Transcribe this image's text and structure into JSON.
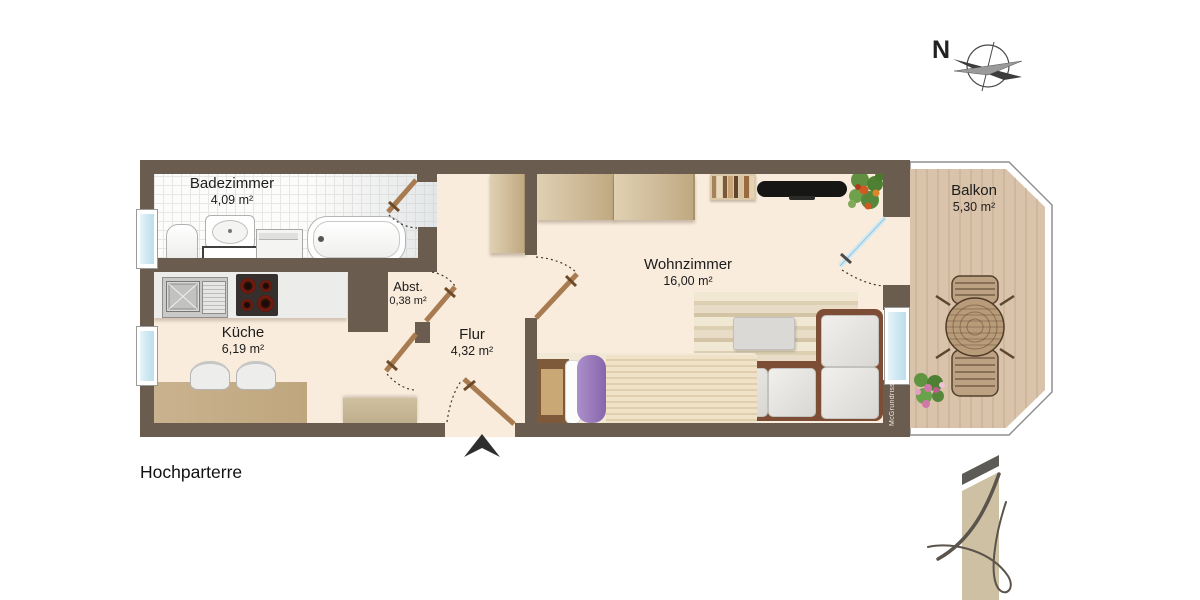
{
  "plan": {
    "floor_label": "Hochparterre",
    "watermark": "McGrundriss",
    "compass": {
      "letter": "N"
    },
    "rooms": [
      {
        "name": "Badezimmer",
        "area": "4,09 m²"
      },
      {
        "name": "Küche",
        "area": "6,19 m²"
      },
      {
        "name": "Abst.",
        "area": "0,38 m²"
      },
      {
        "name": "Flur",
        "area": "4,32 m²"
      },
      {
        "name": "Wohnzimmer",
        "area": "16,00 m²"
      },
      {
        "name": "Balkon",
        "area": "5,30 m²"
      }
    ],
    "colors": {
      "wall": "#6a5c4e",
      "floor": "#f9ecdc",
      "bathroom_tile": "#fcfcfa",
      "balcony_deck": "#d9c3ab",
      "window_glass": "#cfe8f2",
      "door_wood": "#a87c50",
      "sofa_frame": "#7d4e35",
      "duvet_purple": "#9678bd"
    }
  }
}
